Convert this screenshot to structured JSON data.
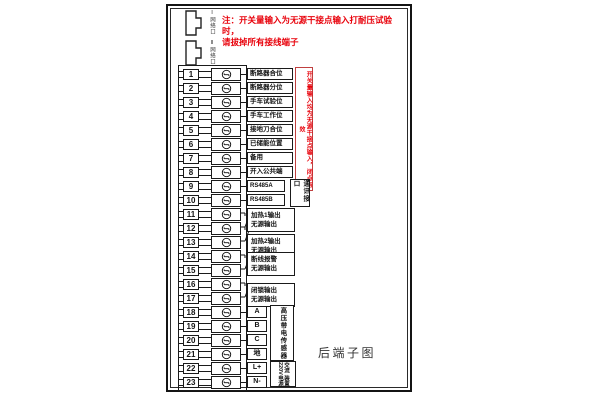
{
  "colors": {
    "red": "#e8000a",
    "line": "#1a1a1a"
  },
  "top_note": {
    "line1": "注：开关量输入为无源干接点输入打耐压试验时，",
    "line2": "请拔掉所有接线端子"
  },
  "connectors": [
    {
      "label": "Ⅰ网络口"
    },
    {
      "label": "Ⅱ网络口"
    }
  ],
  "side_note": "开关量输入均为无源干接点输入，闭点有效",
  "terminals": [
    {
      "no": "1",
      "label": "断路器合位",
      "box": "wide"
    },
    {
      "no": "2",
      "label": "断路器分位",
      "box": "wide"
    },
    {
      "no": "3",
      "label": "手车试验位",
      "box": "wide"
    },
    {
      "no": "4",
      "label": "手车工作位",
      "box": "wide"
    },
    {
      "no": "5",
      "label": "接地刀合位",
      "box": "wide"
    },
    {
      "no": "6",
      "label": "已储能位置",
      "box": "wide"
    },
    {
      "no": "7",
      "label": "备用",
      "box": "wide"
    },
    {
      "no": "8",
      "label": "开入公共端",
      "box": "wide"
    },
    {
      "no": "9",
      "label": "RS485A",
      "box": "mid"
    },
    {
      "no": "10",
      "label": "RS485B",
      "box": "mid"
    },
    {
      "no": "11",
      "label": "",
      "box": "none"
    },
    {
      "no": "12",
      "label": "",
      "box": "none"
    },
    {
      "no": "13",
      "label": "",
      "box": "none"
    },
    {
      "no": "14",
      "label": "",
      "box": "none"
    },
    {
      "no": "15",
      "label": "",
      "box": "none"
    },
    {
      "no": "16",
      "label": "",
      "box": "none"
    },
    {
      "no": "17",
      "label": "",
      "box": "none"
    },
    {
      "no": "18",
      "label": "A",
      "box": "narrow"
    },
    {
      "no": "19",
      "label": "B",
      "box": "narrow"
    },
    {
      "no": "20",
      "label": "C",
      "box": "narrow"
    },
    {
      "no": "21",
      "label": "地",
      "box": "narrow"
    },
    {
      "no": "22",
      "label": "L+",
      "box": "narrow"
    },
    {
      "no": "23",
      "label": "N-",
      "box": "narrow"
    }
  ],
  "pair_outputs": [
    {
      "rows": "11-12",
      "line1": "加热1输出",
      "line2": "无源输出"
    },
    {
      "rows": "12-13",
      "line1": "加热2输出",
      "line2": "无源输出"
    },
    {
      "rows": "14-15",
      "line1": "断线报警",
      "line2": "无源输出"
    },
    {
      "rows": "16-17",
      "line1": "闭锁输出",
      "line2": "无源输出"
    }
  ],
  "brackets": [
    {
      "label": "通讯接口",
      "rows": "9-10"
    },
    {
      "label": "高压带电传感器",
      "rows": "18-21"
    },
    {
      "label": "交流220V",
      "label2": "装置电源",
      "rows": "22-23"
    }
  ],
  "caption": "后端子图"
}
